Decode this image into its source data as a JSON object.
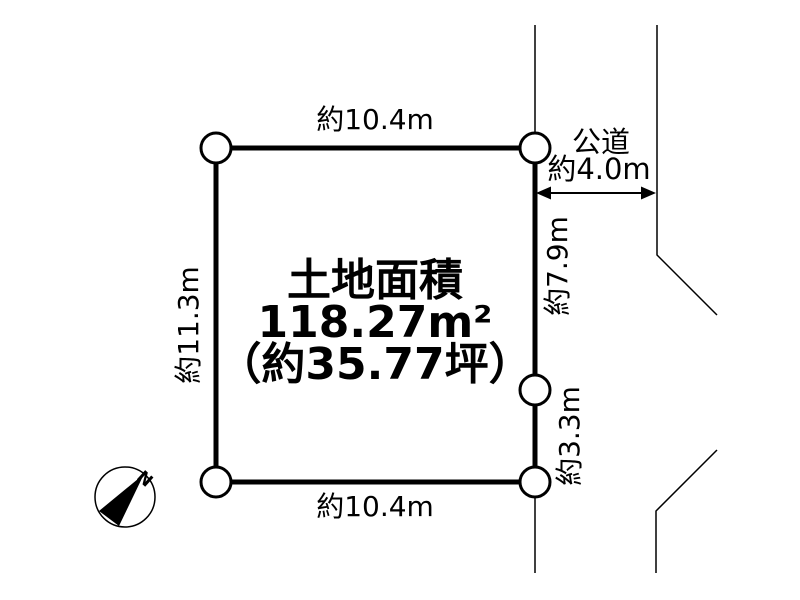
{
  "colors": {
    "line": "#000000",
    "background": "#ffffff"
  },
  "plot": {
    "title": "土地面積",
    "area": "118.27m²",
    "area_tsubo": "（約35.77坪）"
  },
  "dimensions": {
    "top": "約10.4m",
    "bottom": "約10.4m",
    "left": "約11.3m",
    "right_upper": "約7.9m",
    "right_lower": "約3.3m"
  },
  "road": {
    "name": "公道",
    "width": "約4.0m"
  },
  "compass": {
    "north": "N"
  }
}
